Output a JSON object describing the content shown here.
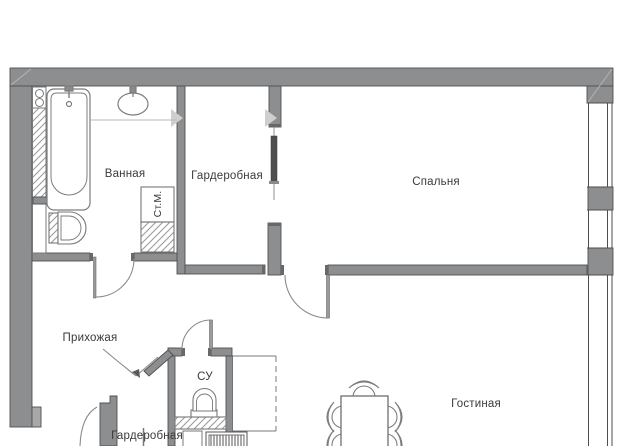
{
  "plan": {
    "type": "apartment-floor-plan",
    "rooms": {
      "bathroom": {
        "label": "Ванная"
      },
      "wardrobe_top": {
        "label": "Гардеробная"
      },
      "bedroom": {
        "label": "Спальня"
      },
      "hallway": {
        "label": "Прихожая"
      },
      "wc": {
        "label": "СУ"
      },
      "wardrobe_bottom": {
        "label": "Гардеробная"
      },
      "living_room": {
        "label": "Гостиная"
      }
    },
    "fixtures": {
      "washing_machine_label": "Ст.М."
    },
    "colors": {
      "wall_fill": "#8d8e90",
      "wall_outline": "#4f5053",
      "furniture_line": "#7d7d7d",
      "hatch_line": "#9b9b9b",
      "window_line": "#4e4e4e",
      "text": "#3a3a3a"
    }
  }
}
